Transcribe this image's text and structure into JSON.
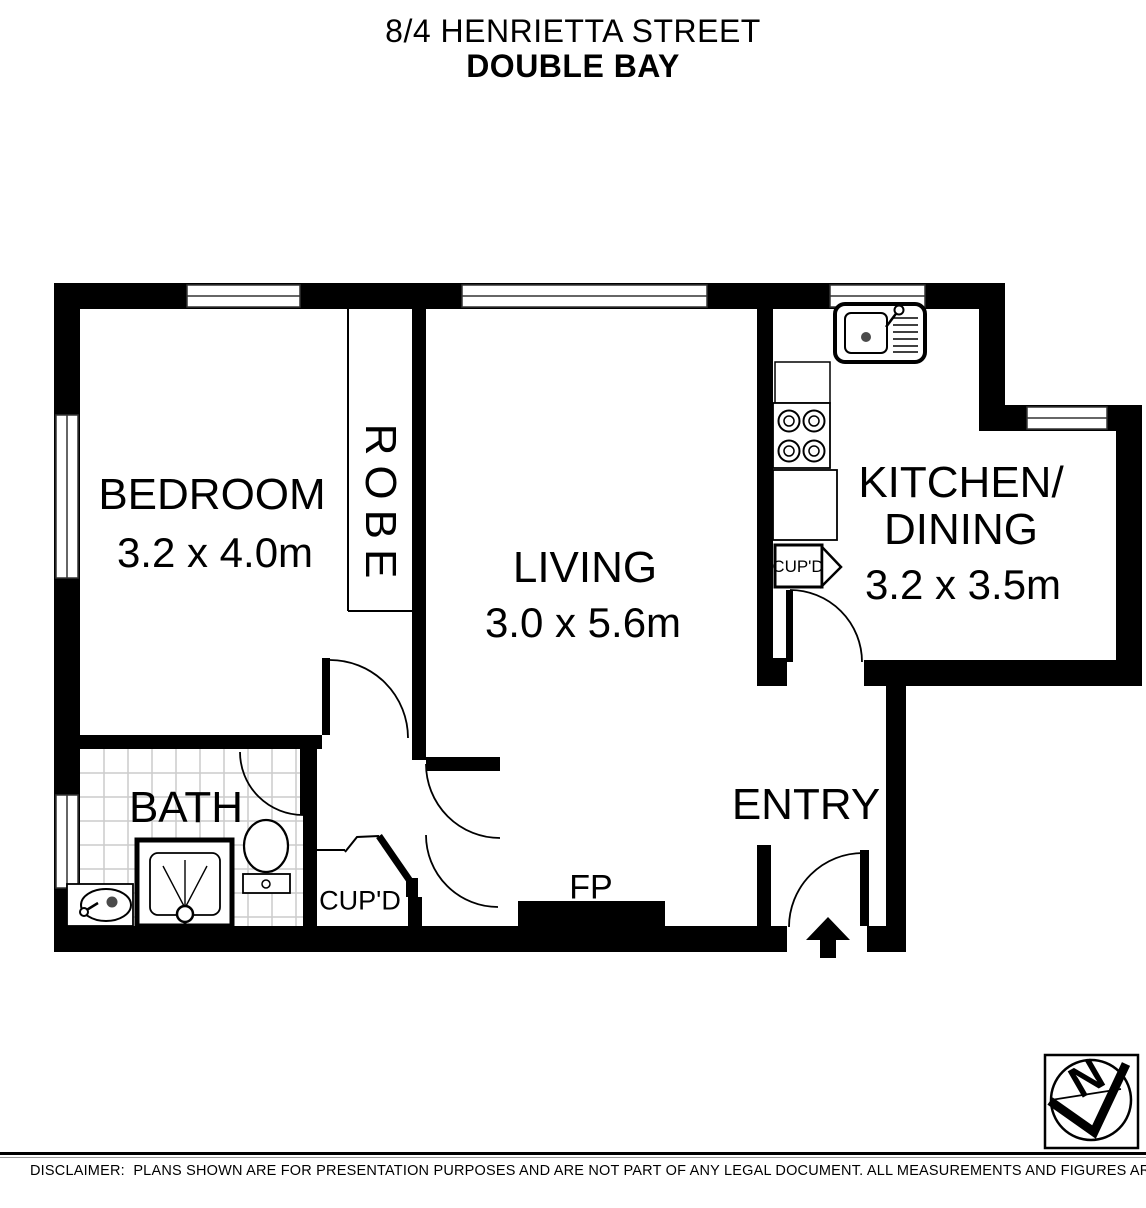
{
  "page_title": {
    "line1": "8/4 HENRIETTA STREET",
    "line2": "DOUBLE BAY"
  },
  "rooms": {
    "bedroom": {
      "name": "BEDROOM",
      "dimensions": "3.2 x 4.0m"
    },
    "living": {
      "name": "LIVING",
      "dimensions": "3.0 x 5.6m"
    },
    "kitchen_dining": {
      "name_line1": "KITCHEN/",
      "name_line2": "DINING",
      "dimensions": "3.2 x 3.5m"
    },
    "bath": {
      "name": "BATH"
    },
    "entry": {
      "name": "ENTRY"
    },
    "robe": {
      "name": "ROBE"
    }
  },
  "features": {
    "fireplace_label": "FP",
    "hall_cupboard_label": "CUP'D",
    "kitchen_cupboard_label": "CUP'D"
  },
  "compass": {
    "north_label": "N"
  },
  "disclaimer": "DISCLAIMER:  PLANS SHOWN ARE FOR PRESENTATION PURPOSES AND ARE NOT PART OF ANY LEGAL DOCUMENT. ALL MEASUREMENTS AND FIGURES ARE APPROXIMATE.",
  "colors": {
    "wall": "#000000",
    "tile_line": "#cccccc",
    "background": "#ffffff"
  }
}
